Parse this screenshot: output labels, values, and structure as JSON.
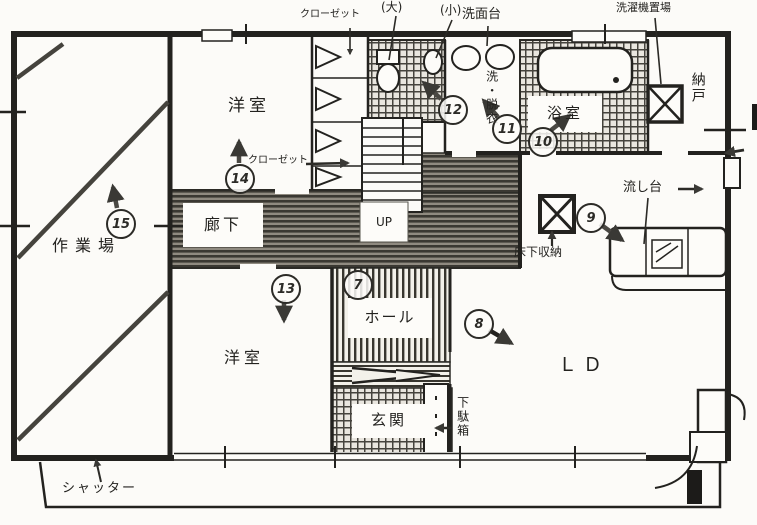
{
  "rooms": {
    "workshop": "作業場",
    "western_room_top": "洋室",
    "western_room_bottom": "洋室",
    "corridor": "廊下",
    "hall": "ホール",
    "entrance": "玄関",
    "living_dining": "ＬＤ",
    "bathroom": "浴室",
    "washroom_vertical": "洗・脱衣",
    "storage_room": "納戸"
  },
  "fixtures": {
    "closet_top": "クローゼット",
    "closet_mid": "クローゼット",
    "toilet_large": "(大)",
    "toilet_small": "(小)",
    "washstand": "洗面台",
    "washing_machine_place": "洗濯機置場",
    "underfloor_storage": "床下収納",
    "kitchen_sink": "流し台",
    "shoe_cabinet": "下駄箱",
    "shutter": "シャッター",
    "stairs_up": "UP"
  },
  "markers": {
    "m7": "7",
    "m8": "8",
    "m9": "9",
    "m10": "10",
    "m11": "11",
    "m12": "12",
    "m13": "13",
    "m14": "14",
    "m15": "15"
  },
  "colors": {
    "ink": "#2b2a26",
    "paper": "#fcfbf8",
    "hatch": "#35332e"
  }
}
